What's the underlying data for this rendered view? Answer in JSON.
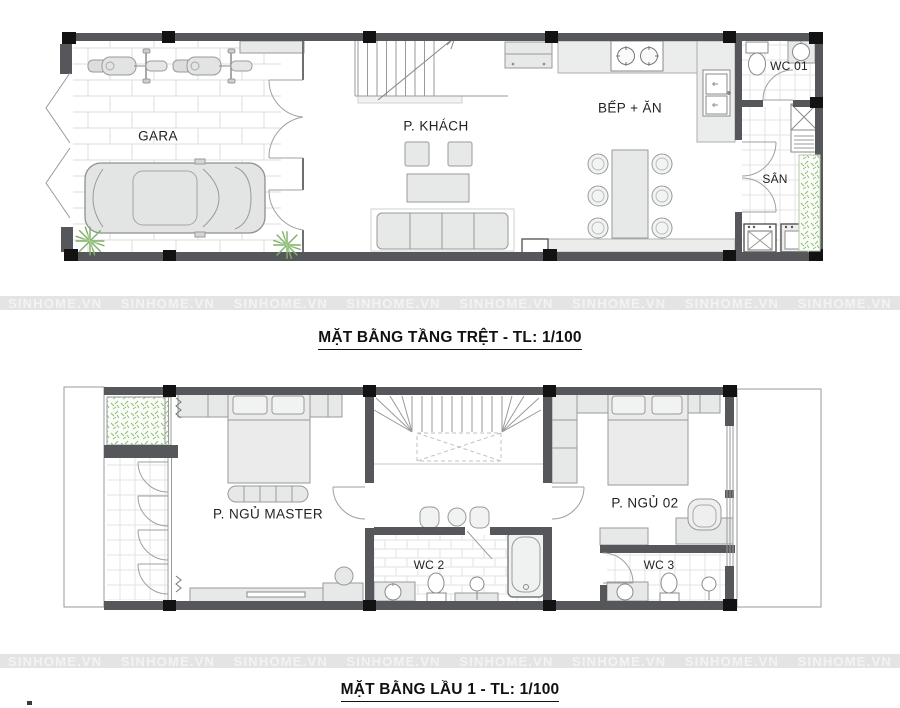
{
  "watermark": {
    "text": "SINHOME.VN",
    "count": 8
  },
  "ground_floor": {
    "title": "MẶT BẰNG TẦNG TRỆT - TL: 1/100",
    "rooms": {
      "garage": "GARA",
      "living": "P. KHÁCH",
      "kitchen": "BẾP + ĂN",
      "wc": "WC 01",
      "yard": "SÂN"
    }
  },
  "first_floor": {
    "title": "MẶT BẰNG LẦU 1 - TL: 1/100",
    "rooms": {
      "master": "P. NGỦ MASTER",
      "wc2": "WC 2",
      "bedroom2": "P. NGỦ 02",
      "wc3": "WC 3"
    }
  },
  "colors": {
    "wall": "#56575a",
    "column": "#121212",
    "furn": "#e7e8e8",
    "line": "#9a9a9a",
    "plant": "#7fb066",
    "wm-band": "#e4e4e4",
    "wm-text": "#f3f3f3",
    "title": "#111111",
    "label": "#222222"
  }
}
